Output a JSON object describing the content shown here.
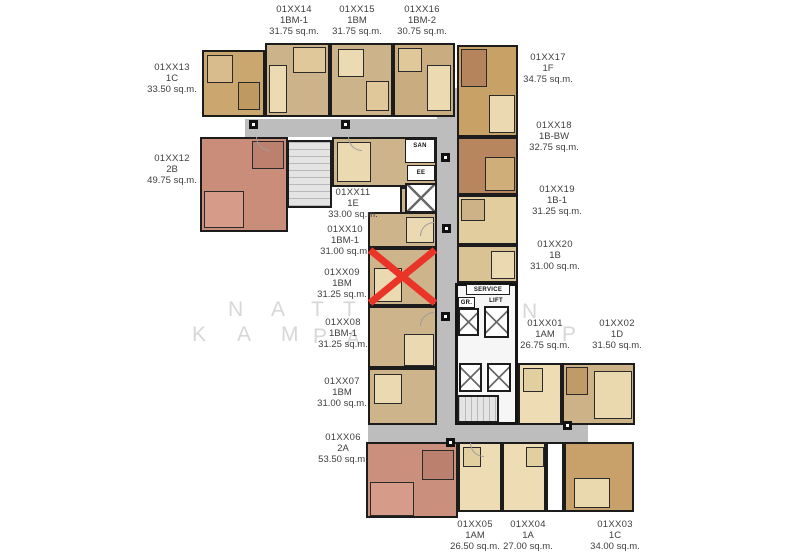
{
  "title": "Residential floor plan",
  "marked_unit": "01XX09",
  "watermark": {
    "line1": [
      "N",
      "A",
      "T",
      "T",
      "N"
    ],
    "line2": [
      "K",
      "A",
      "M",
      "P",
      "A",
      "P"
    ]
  },
  "core": {
    "service_label": "SERVICE",
    "lift_label": "LIFT",
    "gr_label": "GR.",
    "san_label": "SAN",
    "ee_label": "EE"
  },
  "colors": {
    "tan": "#cdb389",
    "dark_tan": "#c7a166",
    "brown": "#b8865e",
    "cream": "#eddcb4",
    "pink": "#ca8f7d",
    "corridor": "#bdbdbd",
    "wall": "#1c1c1c",
    "red_x": "#e93427"
  },
  "units": {
    "u01": {
      "code": "01XX01",
      "type": "1AM",
      "area": "26.75 sq.m."
    },
    "u02": {
      "code": "01XX02",
      "type": "1D",
      "area": "31.50 sq.m."
    },
    "u03": {
      "code": "01XX03",
      "type": "1C",
      "area": "34.00 sq.m."
    },
    "u04": {
      "code": "01XX04",
      "type": "1A",
      "area": "27.00 sq.m."
    },
    "u05": {
      "code": "01XX05",
      "type": "1AM",
      "area": "26.50 sq.m."
    },
    "u06": {
      "code": "01XX06",
      "type": "2A",
      "area": "53.50 sq.m."
    },
    "u07": {
      "code": "01XX07",
      "type": "1BM",
      "area": "31.00 sq.m."
    },
    "u08": {
      "code": "01XX08",
      "type": "1BM-1",
      "area": "31.25 sq.m."
    },
    "u09": {
      "code": "01XX09",
      "type": "1BM",
      "area": "31.25 sq.m."
    },
    "u10": {
      "code": "01XX10",
      "type": "1BM-1",
      "area": "31.00 sq.m."
    },
    "u11": {
      "code": "01XX11",
      "type": "1E",
      "area": "33.00 sq.m."
    },
    "u12": {
      "code": "01XX12",
      "type": "2B",
      "area": "49.75 sq.m."
    },
    "u13": {
      "code": "01XX13",
      "type": "1C",
      "area": "33.50 sq.m."
    },
    "u14": {
      "code": "01XX14",
      "type": "1BM-1",
      "area": "31.75 sq.m."
    },
    "u15": {
      "code": "01XX15",
      "type": "1BM",
      "area": "31.75 sq.m."
    },
    "u16": {
      "code": "01XX16",
      "type": "1BM-2",
      "area": "30.75 sq.m."
    },
    "u17": {
      "code": "01XX17",
      "type": "1F",
      "area": "34.75 sq.m."
    },
    "u18": {
      "code": "01XX18",
      "type": "1B-BW",
      "area": "32.75 sq.m."
    },
    "u19": {
      "code": "01XX19",
      "type": "1B-1",
      "area": "31.25 sq.m."
    },
    "u20": {
      "code": "01XX20",
      "type": "1B",
      "area": "31.00 sq.m."
    }
  }
}
